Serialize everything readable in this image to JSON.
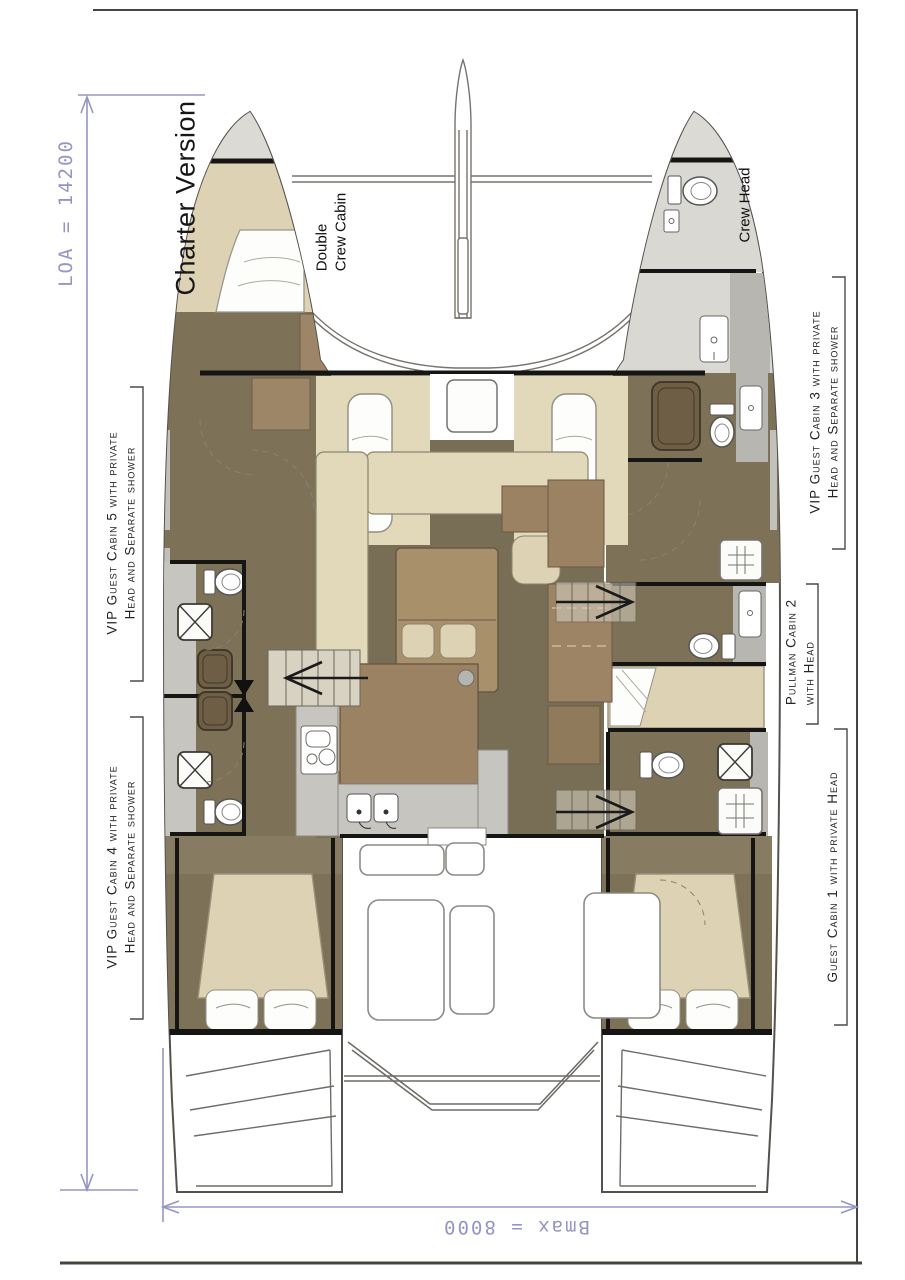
{
  "drawing": {
    "title": "Charter Version",
    "dim_loa": "LOA = 14200",
    "dim_bmax": "Bmax = 8000"
  },
  "labels": {
    "crew_cabin_l1": "Double",
    "crew_cabin_l2": "Crew Cabin",
    "crew_head": "Crew Head",
    "cabin5_l1": "VIP Guest Cabin 5 with private",
    "cabin5_l2": "Head and Separate shower",
    "cabin4_l1": "VIP Guest Cabin 4 with private",
    "cabin4_l2": "Head and Separate shower",
    "cabin3_l1": "VIP Guest Cabin 3 with private",
    "cabin3_l2": "Head and Separate shower",
    "cabin2_l1": "Pullman Cabin 2",
    "cabin2_l2": "with Head",
    "cabin1_l1": "Guest Cabin 1 with private Head"
  },
  "colors": {
    "dim": "#9595c5",
    "ink": "#1b1b1b",
    "wall": "#151513",
    "line": "#8b8880",
    "outline": "#55524d",
    "olive": "#776e55",
    "brown": "#7d7157",
    "brown2": "#877b61",
    "bed": "#ddd3b4",
    "sofa": "#e2d8ba",
    "wood": "#a8906b",
    "wood2": "#9a8262",
    "dark_fixture": "#6d5e45",
    "gray": "#c6c5c0",
    "deckgray": "#dbdad4",
    "band": "#b8b6b0",
    "paper": "#ffffff"
  }
}
